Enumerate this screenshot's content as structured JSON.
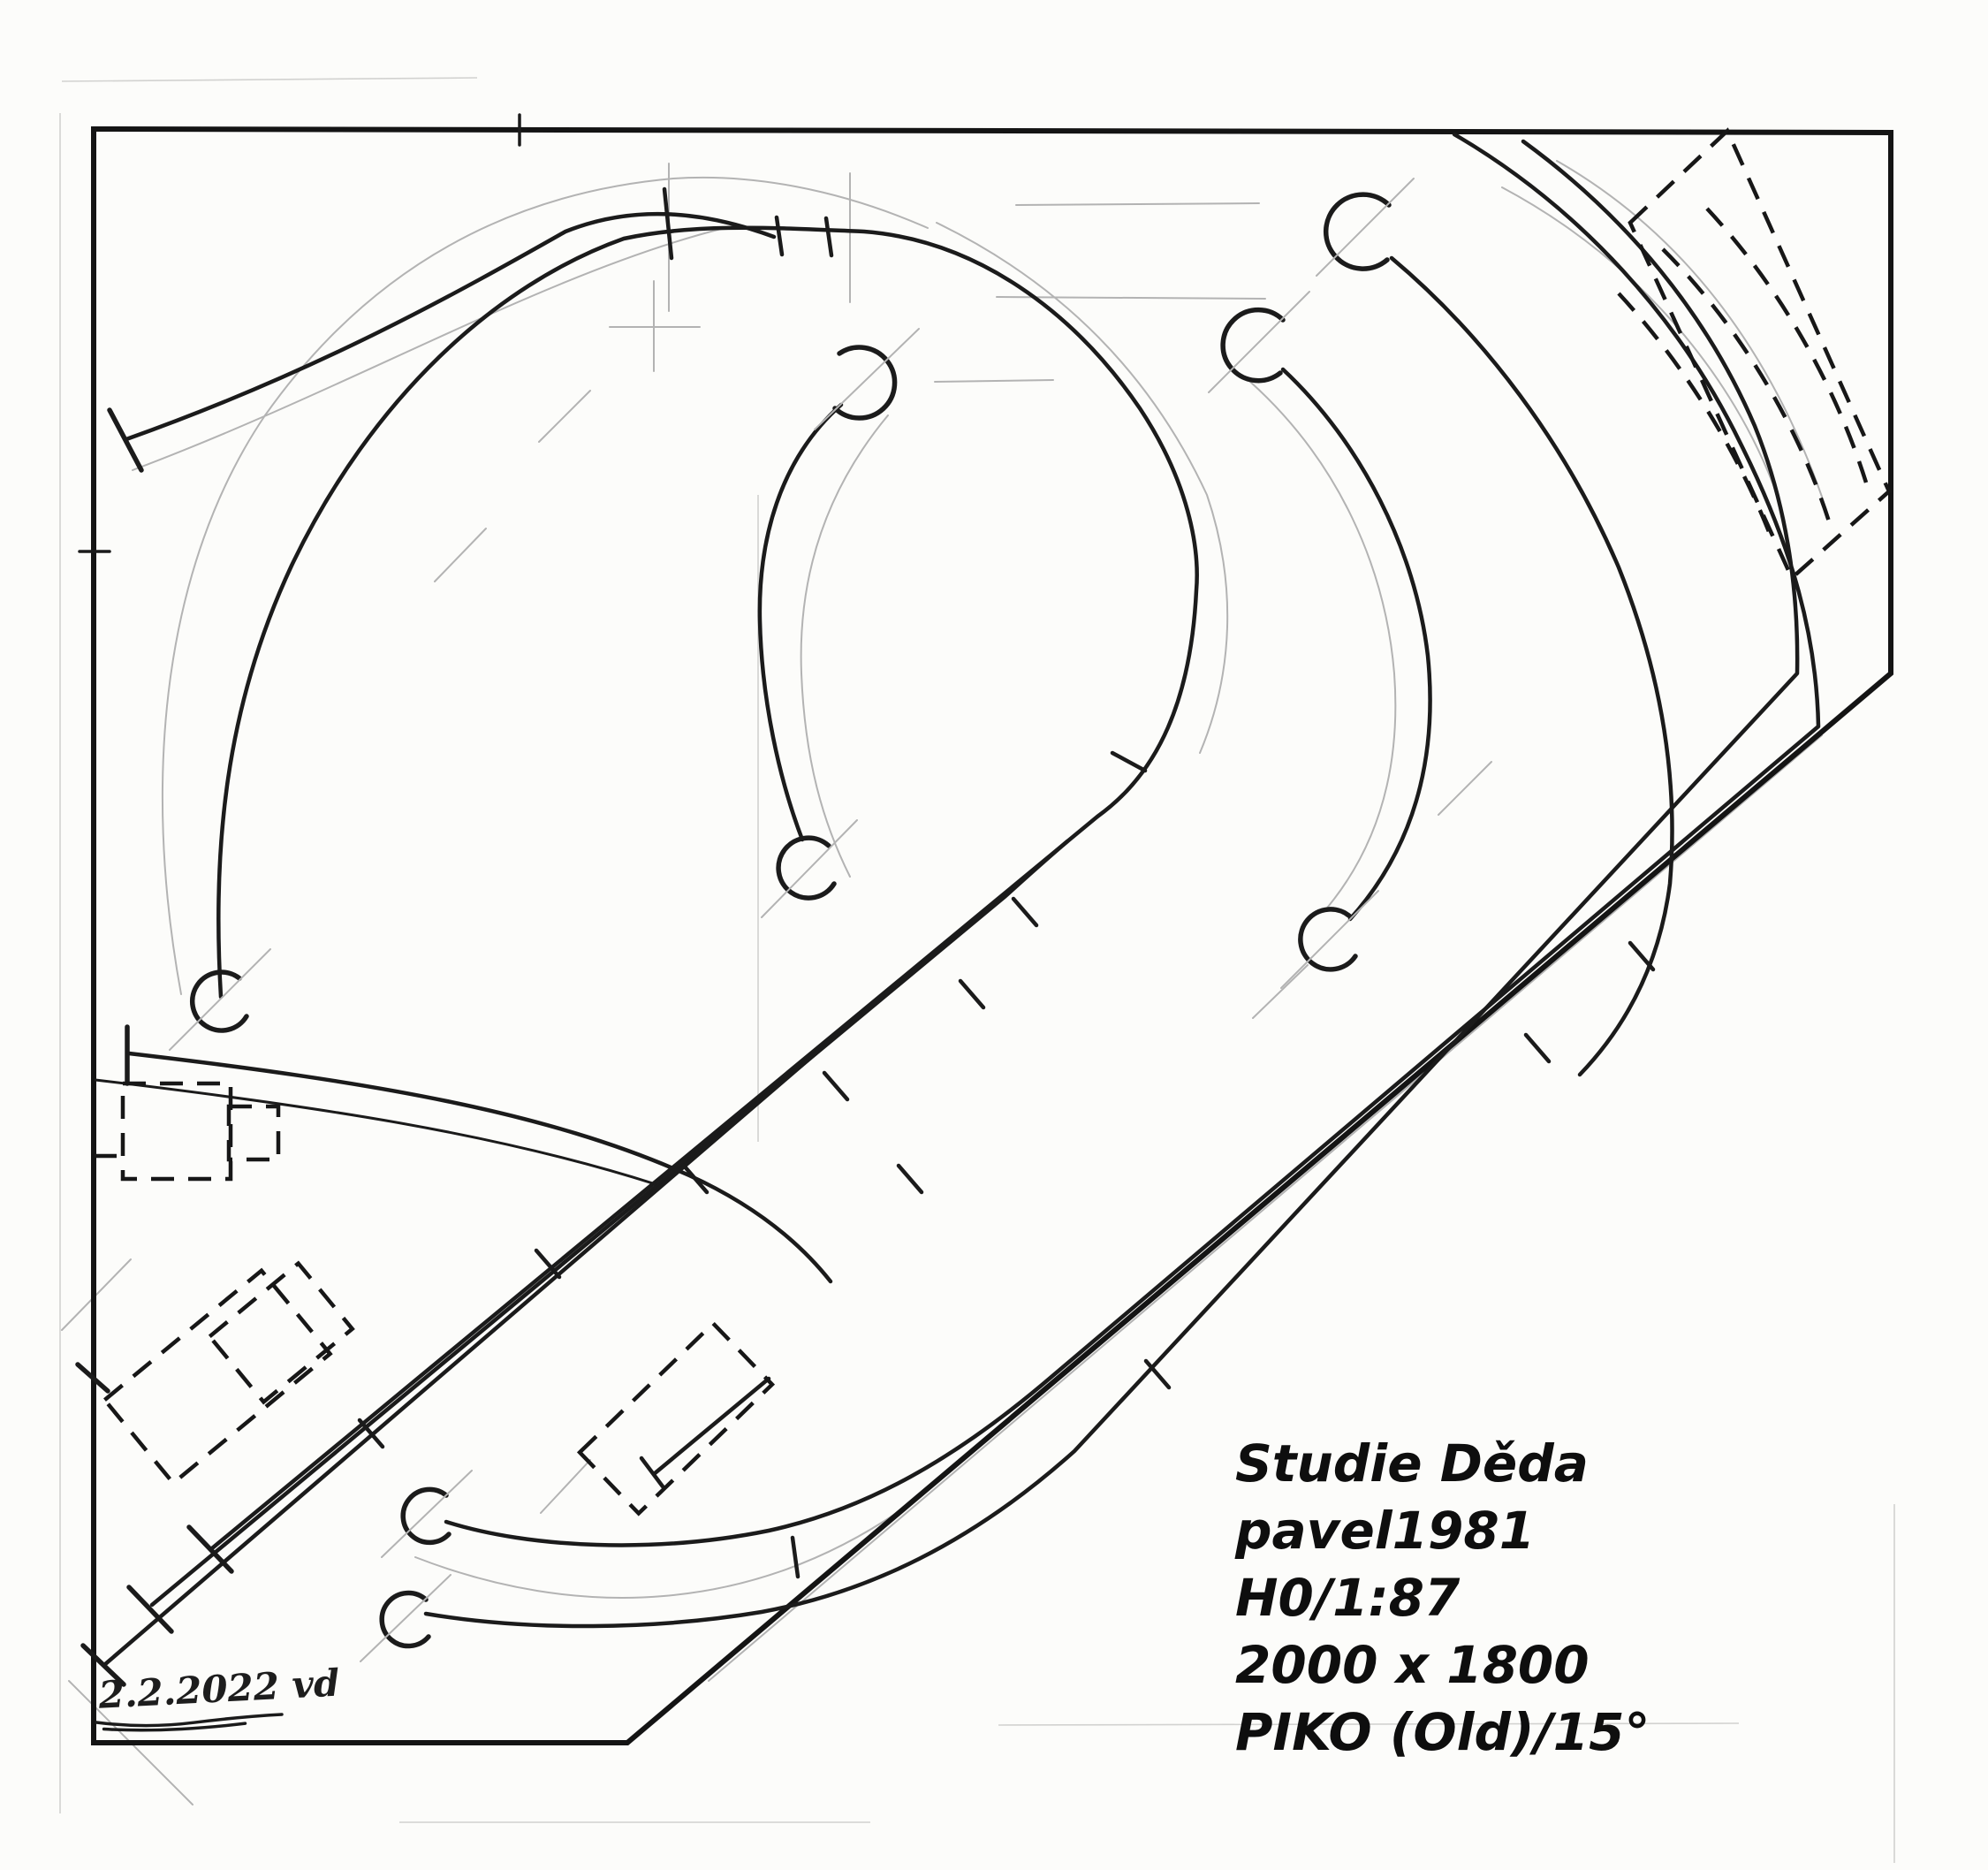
{
  "document": {
    "kind": "scanned hand-drawn model railway track plan",
    "background_color": "#fcfcfa",
    "ink_color": "#1b1b1b",
    "pencil_color": "#b3b3b3",
    "text_color": "#0e0e0e"
  },
  "title_block": {
    "lines": [
      "Studie Děda",
      "pavel1981",
      "H0/1:87",
      "2000 x 1800",
      "PIKO (Old)/15°"
    ]
  },
  "signature": {
    "text": "2.2.2022 vd"
  }
}
